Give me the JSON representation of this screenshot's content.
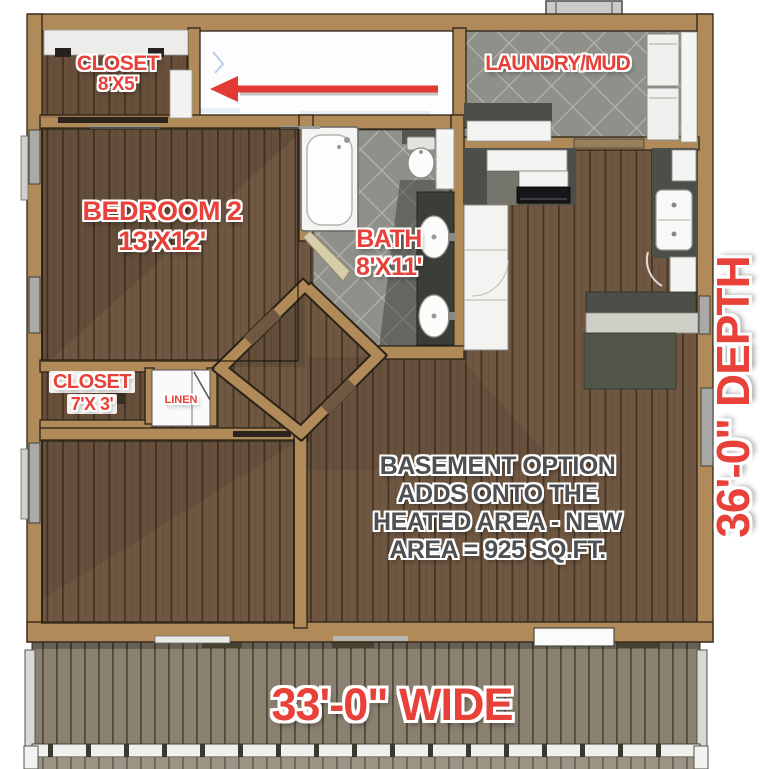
{
  "plan_title": "Basement Option Floor Plan",
  "rooms": {
    "closet_top": {
      "label": "CLOSET",
      "size": "8'X5'"
    },
    "bedroom2": {
      "label": "BEDROOM 2",
      "size": "13'X12'"
    },
    "bath": {
      "label": "BATH",
      "size": "8'X11'"
    },
    "laundry": {
      "label": "LAUNDRY/MUD"
    },
    "closet_bottom": {
      "label": "CLOSET",
      "size": "7'X 3'"
    },
    "linen": {
      "label": "LINEN"
    }
  },
  "note": {
    "line1": "BASEMENT OPTION",
    "line2": "ADDS ONTO THE",
    "line3": "HEATED AREA - NEW",
    "line4": "AREA = 925 SQ.FT."
  },
  "dimensions": {
    "width_label": "33'-0\" WIDE",
    "depth_label": "36'-0\" DEPTH"
  },
  "annotations": {
    "arrow_direction": "left"
  },
  "colors": {
    "label_red": "#e8413a",
    "note_gray": "#4d4f52",
    "wall_tan": "#b08a58",
    "wood_brown": "#6f5741",
    "tile_gray": "#8f9089",
    "deck_gray": "#8b8170",
    "arrow_red": "#e23b36"
  }
}
